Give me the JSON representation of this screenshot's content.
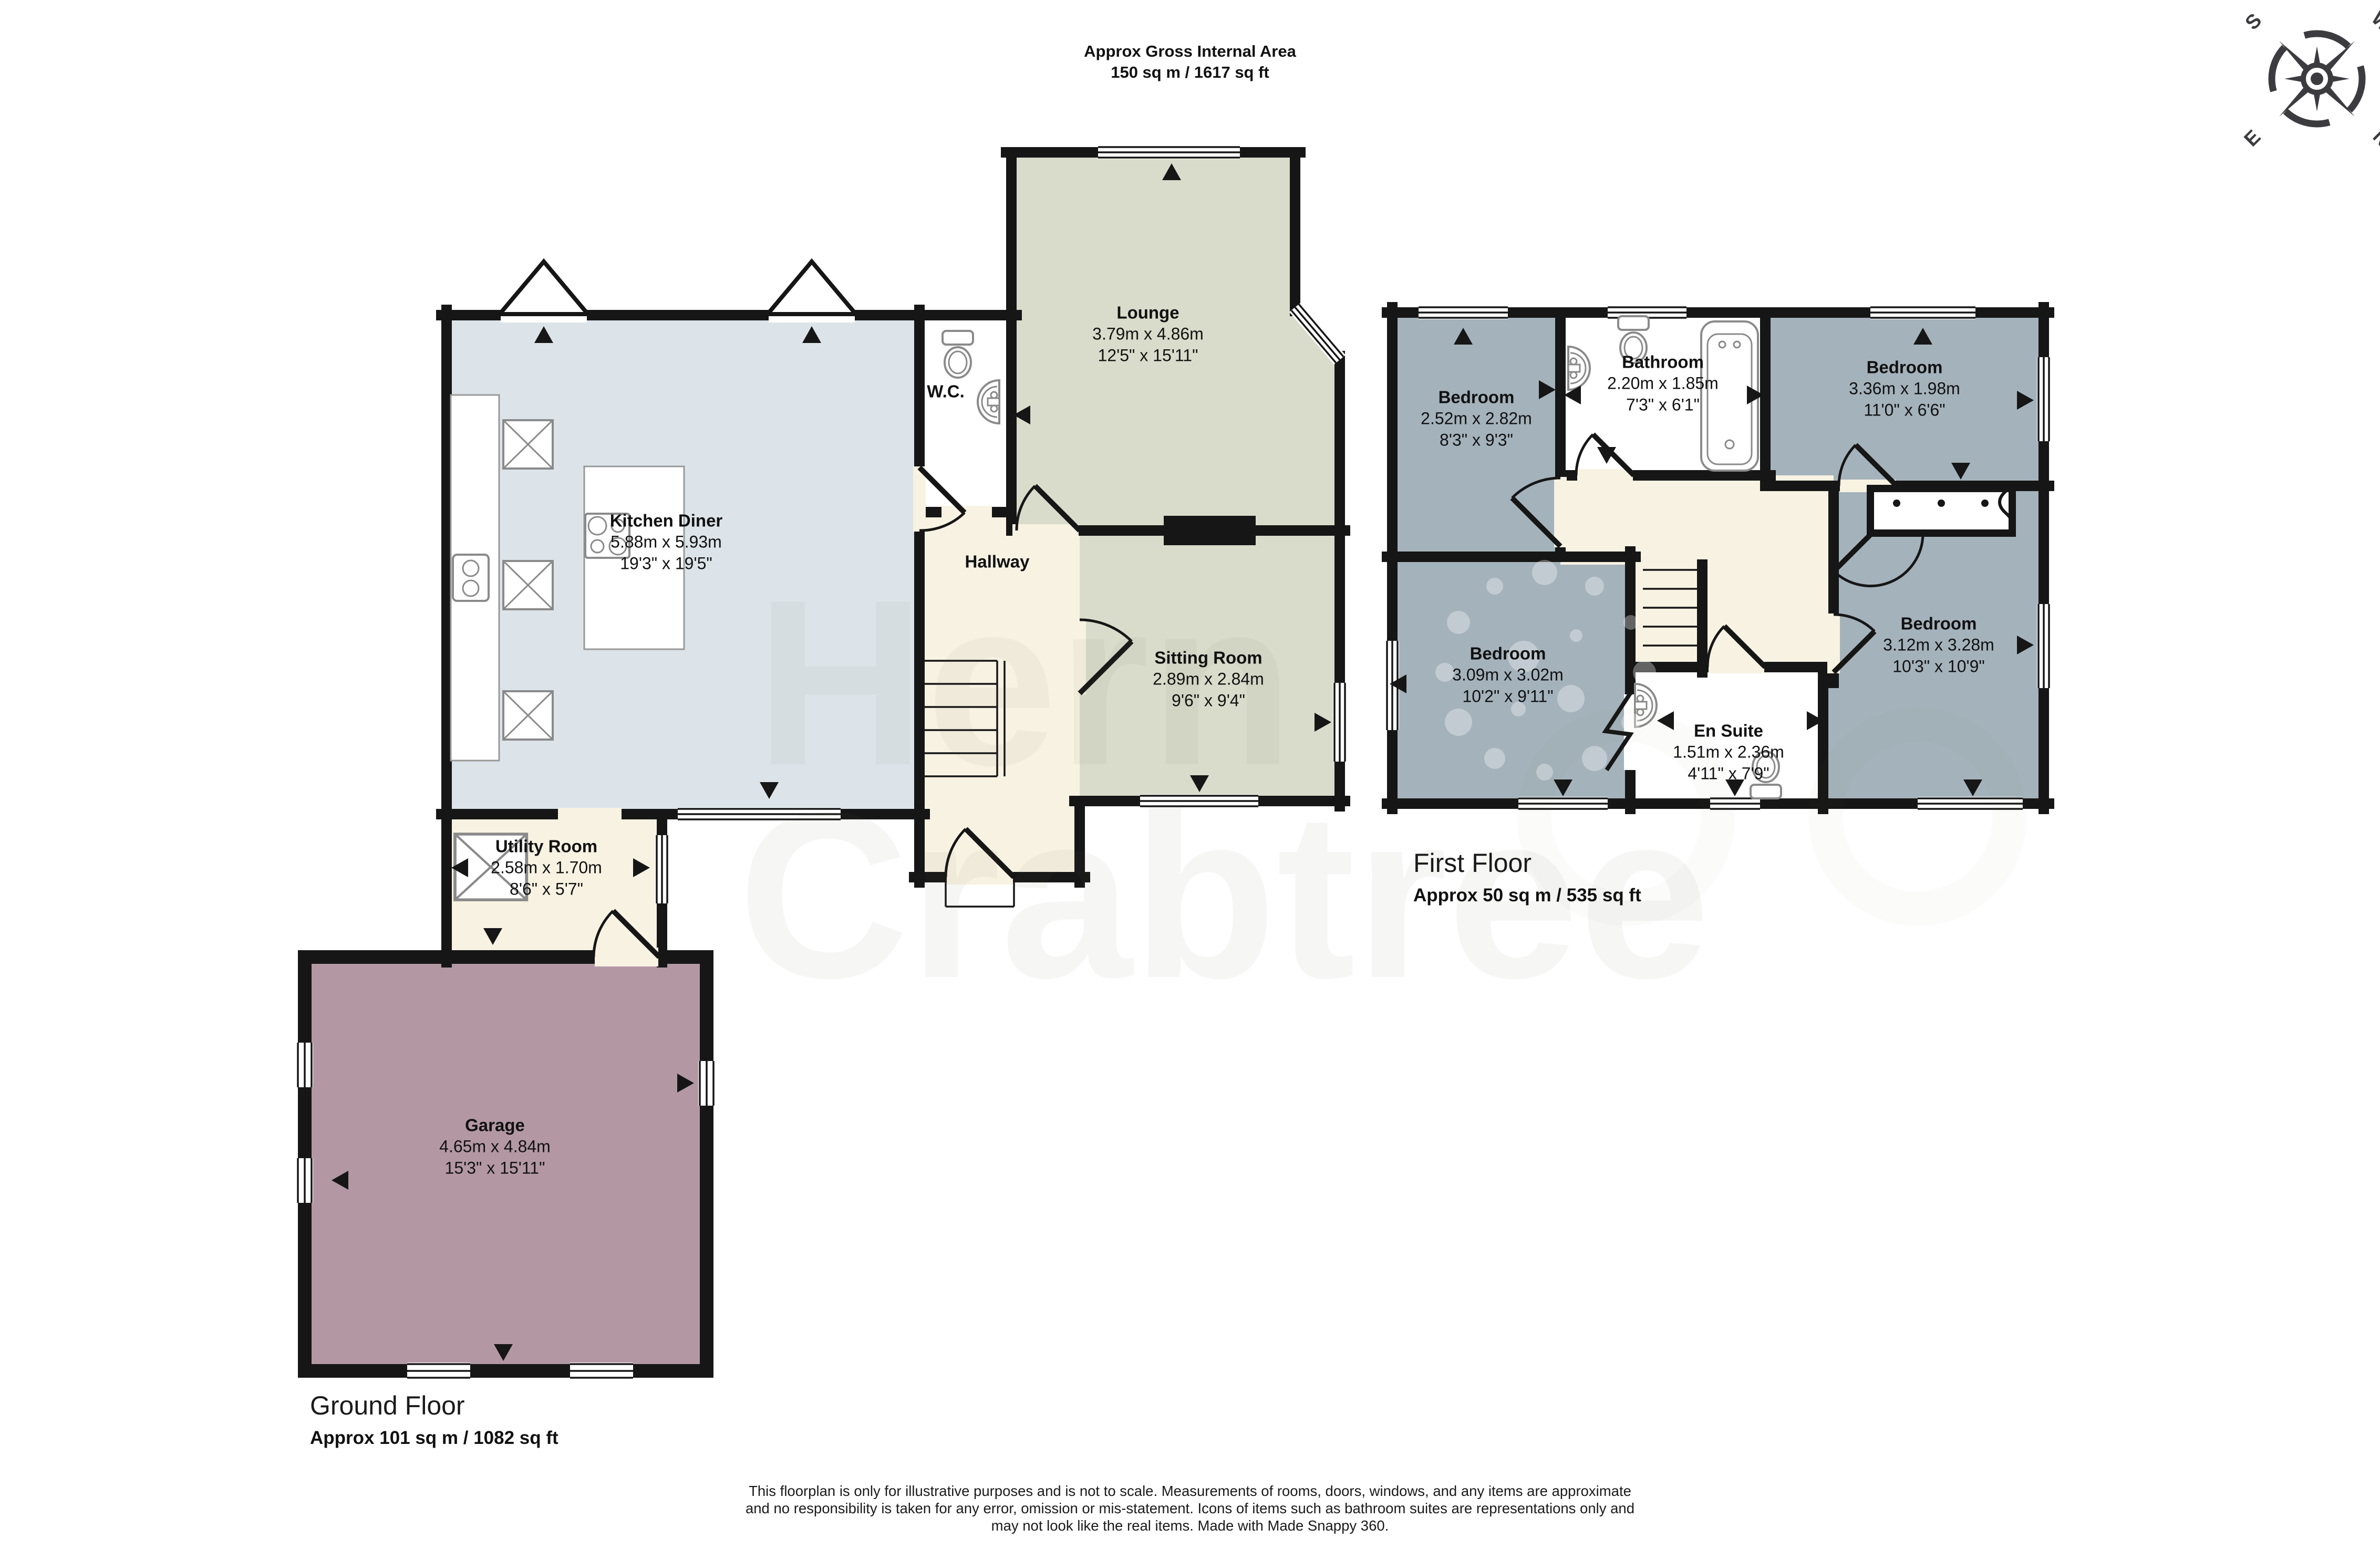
{
  "header": {
    "title": "Approx Gross Internal Area",
    "subtitle": "150 sq m / 1617 sq ft"
  },
  "compass": {
    "n": "N",
    "e": "E",
    "s": "S",
    "w": "W"
  },
  "ground_floor": {
    "name": "Ground Floor",
    "area": "Approx 101 sq m / 1082 sq ft",
    "rooms": {
      "kitchen": {
        "name": "Kitchen Diner",
        "metric": "5.88m x 5.93m",
        "imperial": "19'3\" x 19'5\""
      },
      "wc": {
        "name": "W.C."
      },
      "lounge": {
        "name": "Lounge",
        "metric": "3.79m x 4.86m",
        "imperial": "12'5\" x 15'11\""
      },
      "hallway": {
        "name": "Hallway"
      },
      "sitting_room": {
        "name": "Sitting Room",
        "metric": "2.89m x 2.84m",
        "imperial": "9'6\" x 9'4\""
      },
      "utility": {
        "name": "Utility Room",
        "metric": "2.58m x 1.70m",
        "imperial": "8'6\" x 5'7\""
      },
      "garage": {
        "name": "Garage",
        "metric": "4.65m x 4.84m",
        "imperial": "15'3\" x 15'11\""
      }
    }
  },
  "first_floor": {
    "name": "First Floor",
    "area": "Approx 50 sq m / 535 sq ft",
    "rooms": {
      "bedroom_front": {
        "name": "Bedroom",
        "metric": "2.52m x 2.82m",
        "imperial": "8'3\" x 9'3\""
      },
      "bathroom": {
        "name": "Bathroom",
        "metric": "2.20m x 1.85m",
        "imperial": "7'3\" x 6'1\""
      },
      "bedroom_top_right": {
        "name": "Bedroom",
        "metric": "3.36m x 1.98m",
        "imperial": "11'0\" x 6'6\""
      },
      "bedroom_bottom_left": {
        "name": "Bedroom",
        "metric": "3.09m x 3.02m",
        "imperial": "10'2\" x 9'11\""
      },
      "ensuite": {
        "name": "En Suite",
        "metric": "1.51m x 2.36m",
        "imperial": "4'11\" x 7'9\""
      },
      "bedroom_bottom_right": {
        "name": "Bedroom",
        "metric": "3.12m x 3.28m",
        "imperial": "10'3\" x 10'9\""
      }
    }
  },
  "watermark": {
    "line1": "Hern",
    "line2": "Crabtree"
  },
  "disclaimer": {
    "line1": "This floorplan is only for illustrative purposes and is not to scale. Measurements of rooms, doors, windows, and any items are approximate",
    "line2": "and no responsibility is taken for any error, omission or mis-statement. Icons of items such as bathroom suites are representations only and",
    "line3": "may not look like the real items. Made with Made Snappy 360."
  },
  "colors": {
    "kitchen_fill": "#dce4e9",
    "lounge_fill": "#d9dcca",
    "hall_fill": "#f7f2e2",
    "garage_fill": "#b398a4",
    "bedroom_fill": "#a4b2bb",
    "bath_fill": "#ffffff",
    "wall": "#161616",
    "fixture_stroke": "#8a8a8a",
    "compass": "#3c3c40"
  }
}
